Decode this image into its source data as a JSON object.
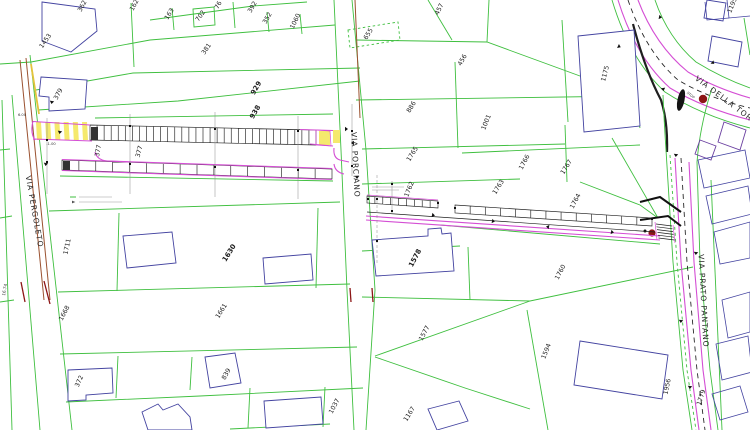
{
  "drawing": {
    "title": "Planimetria catastale con progetto marciapiedi",
    "colors": {
      "green": "#3fbf3f",
      "navy": "#4343a0",
      "purple": "#6a3fa0",
      "magenta": "#d44ed4",
      "yellow": "#f5e96d",
      "yellowline": "#e3c33c",
      "brown": "#9a512f",
      "darkred": "#8c1616",
      "black": "#1f1f1f"
    },
    "streets": [
      {
        "label": "VIA PERGOLETO",
        "x": 32,
        "y": 212,
        "rotate": 80
      },
      {
        "label": "VIA PORCIANO",
        "x": 353,
        "y": 165,
        "rotate": 87
      },
      {
        "label": "VIA DELLA TORRE",
        "x": 727,
        "y": 104,
        "rotate": 37
      },
      {
        "label": "VIA PRATO PANTANO",
        "x": 701,
        "y": 301,
        "rotate": 87
      }
    ],
    "parcel_labels": [
      {
        "text": "362",
        "x": 84,
        "y": 7,
        "rotate": -62
      },
      {
        "text": "1453",
        "x": 47,
        "y": 42,
        "rotate": -55
      },
      {
        "text": "379",
        "x": 60,
        "y": 95,
        "rotate": -62
      },
      {
        "text": "162",
        "x": 136,
        "y": 6,
        "rotate": -62
      },
      {
        "text": "163",
        "x": 171,
        "y": 15,
        "rotate": -58
      },
      {
        "text": "702",
        "x": 202,
        "y": 17,
        "rotate": -55
      },
      {
        "text": "76",
        "x": 220,
        "y": 6,
        "rotate": -62
      },
      {
        "text": "392",
        "x": 254,
        "y": 8,
        "rotate": -60
      },
      {
        "text": "352",
        "x": 269,
        "y": 19,
        "rotate": -60
      },
      {
        "text": "1060",
        "x": 297,
        "y": 22,
        "rotate": -64
      },
      {
        "text": "381",
        "x": 208,
        "y": 50,
        "rotate": -56
      },
      {
        "text": "929",
        "x": 258,
        "y": 89,
        "rotate": -60,
        "bold": true
      },
      {
        "text": "938",
        "x": 257,
        "y": 113,
        "rotate": -60,
        "bold": true
      },
      {
        "text": "457",
        "x": 441,
        "y": 10,
        "rotate": -64
      },
      {
        "text": "655",
        "x": 370,
        "y": 35,
        "rotate": -58
      },
      {
        "text": "456",
        "x": 464,
        "y": 61,
        "rotate": -60
      },
      {
        "text": "886",
        "x": 413,
        "y": 108,
        "rotate": -58
      },
      {
        "text": "1001",
        "x": 488,
        "y": 123,
        "rotate": -68
      },
      {
        "text": "1175",
        "x": 607,
        "y": 74,
        "rotate": -76
      },
      {
        "text": "1195",
        "x": 734,
        "y": 6,
        "rotate": -68
      },
      {
        "text": "1765",
        "x": 414,
        "y": 155,
        "rotate": -58
      },
      {
        "text": "1766",
        "x": 526,
        "y": 163,
        "rotate": -62
      },
      {
        "text": "1767",
        "x": 568,
        "y": 168,
        "rotate": -58
      },
      {
        "text": "1763",
        "x": 500,
        "y": 188,
        "rotate": -58
      },
      {
        "text": "1764",
        "x": 577,
        "y": 202,
        "rotate": -62
      },
      {
        "text": "1762",
        "x": 411,
        "y": 190,
        "rotate": -68
      },
      {
        "text": "377",
        "x": 100,
        "y": 151,
        "rotate": -80
      },
      {
        "text": "377",
        "x": 141,
        "y": 152,
        "rotate": -75
      },
      {
        "text": "1711",
        "x": 69,
        "y": 247,
        "rotate": -78
      },
      {
        "text": "1630",
        "x": 231,
        "y": 254,
        "rotate": -58,
        "bold": true
      },
      {
        "text": "1578",
        "x": 417,
        "y": 259,
        "rotate": -62,
        "bold": true
      },
      {
        "text": "1760",
        "x": 562,
        "y": 273,
        "rotate": -62
      },
      {
        "text": "1661",
        "x": 223,
        "y": 312,
        "rotate": -58
      },
      {
        "text": "1668",
        "x": 66,
        "y": 314,
        "rotate": -62
      },
      {
        "text": "372",
        "x": 81,
        "y": 382,
        "rotate": -66
      },
      {
        "text": "839",
        "x": 228,
        "y": 375,
        "rotate": -62
      },
      {
        "text": "1577",
        "x": 426,
        "y": 334,
        "rotate": -62
      },
      {
        "text": "1594",
        "x": 548,
        "y": 352,
        "rotate": -68
      },
      {
        "text": "1037",
        "x": 336,
        "y": 407,
        "rotate": -62
      },
      {
        "text": "1167",
        "x": 411,
        "y": 415,
        "rotate": -58
      },
      {
        "text": "1956",
        "x": 669,
        "y": 387,
        "rotate": -78
      },
      {
        "text": "1779",
        "x": 703,
        "y": 398,
        "rotate": -72
      }
    ],
    "annotations": [
      {
        "text": "6.00",
        "x": 22,
        "y": 116,
        "rotate": 0,
        "size": 3.6
      },
      {
        "text": "-1.00",
        "x": 51,
        "y": 145,
        "rotate": 0,
        "size": 3.6
      },
      {
        "text": "16.74",
        "x": 6,
        "y": 290,
        "rotate": -80,
        "size": 4.2
      },
      {
        "text": "STOP",
        "x": 690,
        "y": 96,
        "rotate": 38,
        "size": 3.4
      }
    ]
  }
}
